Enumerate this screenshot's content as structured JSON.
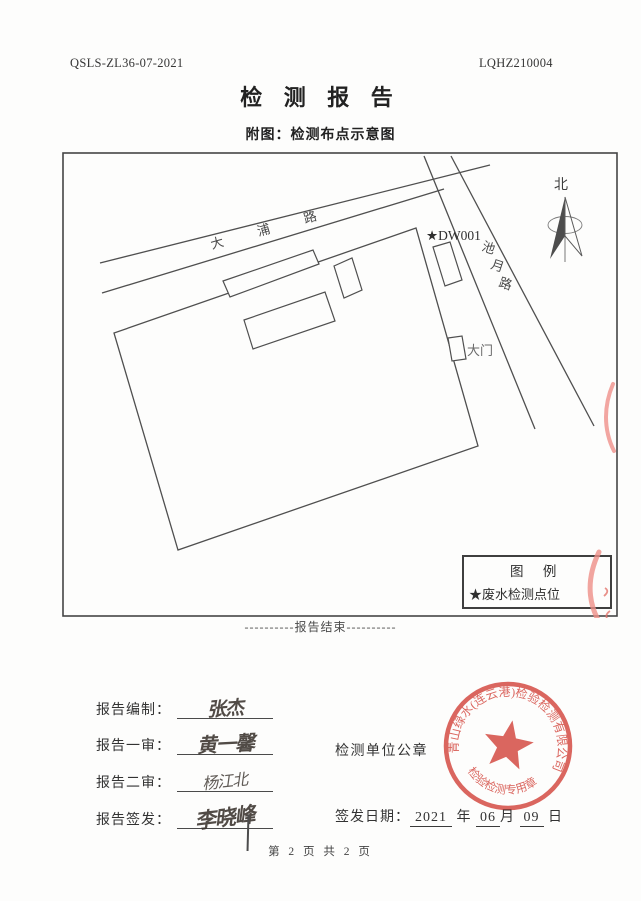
{
  "header": {
    "doc_code_left": "QSLS-ZL36-07-2021",
    "doc_code_right": "LQHZ210004",
    "title": "检 测 报 告",
    "subtitle": "附图：检测布点示意图"
  },
  "map": {
    "road_dapu": "大 浦 路",
    "road_chiyue": "池月路",
    "north_label": "北",
    "point_label": "★DW001",
    "gate_label": "大门",
    "legend_title": "图  例",
    "legend_item": "★废水检测点位"
  },
  "report_end_text": "----------报告结束----------",
  "signoff": {
    "rows": [
      {
        "label": "报告编制：",
        "name": "张杰"
      },
      {
        "label": "报告一审：",
        "name": "黄一馨"
      },
      {
        "label": "报告二审：",
        "name": "杨江北"
      },
      {
        "label": "报告签发：",
        "name": "李晓峰"
      }
    ],
    "seal_caption": "检测单位公章",
    "date_label": "签发日期：",
    "date": {
      "year": "2021",
      "year_unit": "年",
      "month": "06",
      "month_unit": "月",
      "day": "09",
      "day_unit": "日"
    }
  },
  "seal": {
    "company_arc": "青山绿水(连云港)检验检测有限公司",
    "bottom_arc": "检验检测专用章",
    "color": "#d8524a"
  },
  "footer": {
    "page_info": "第 2 页 共 2 页"
  }
}
